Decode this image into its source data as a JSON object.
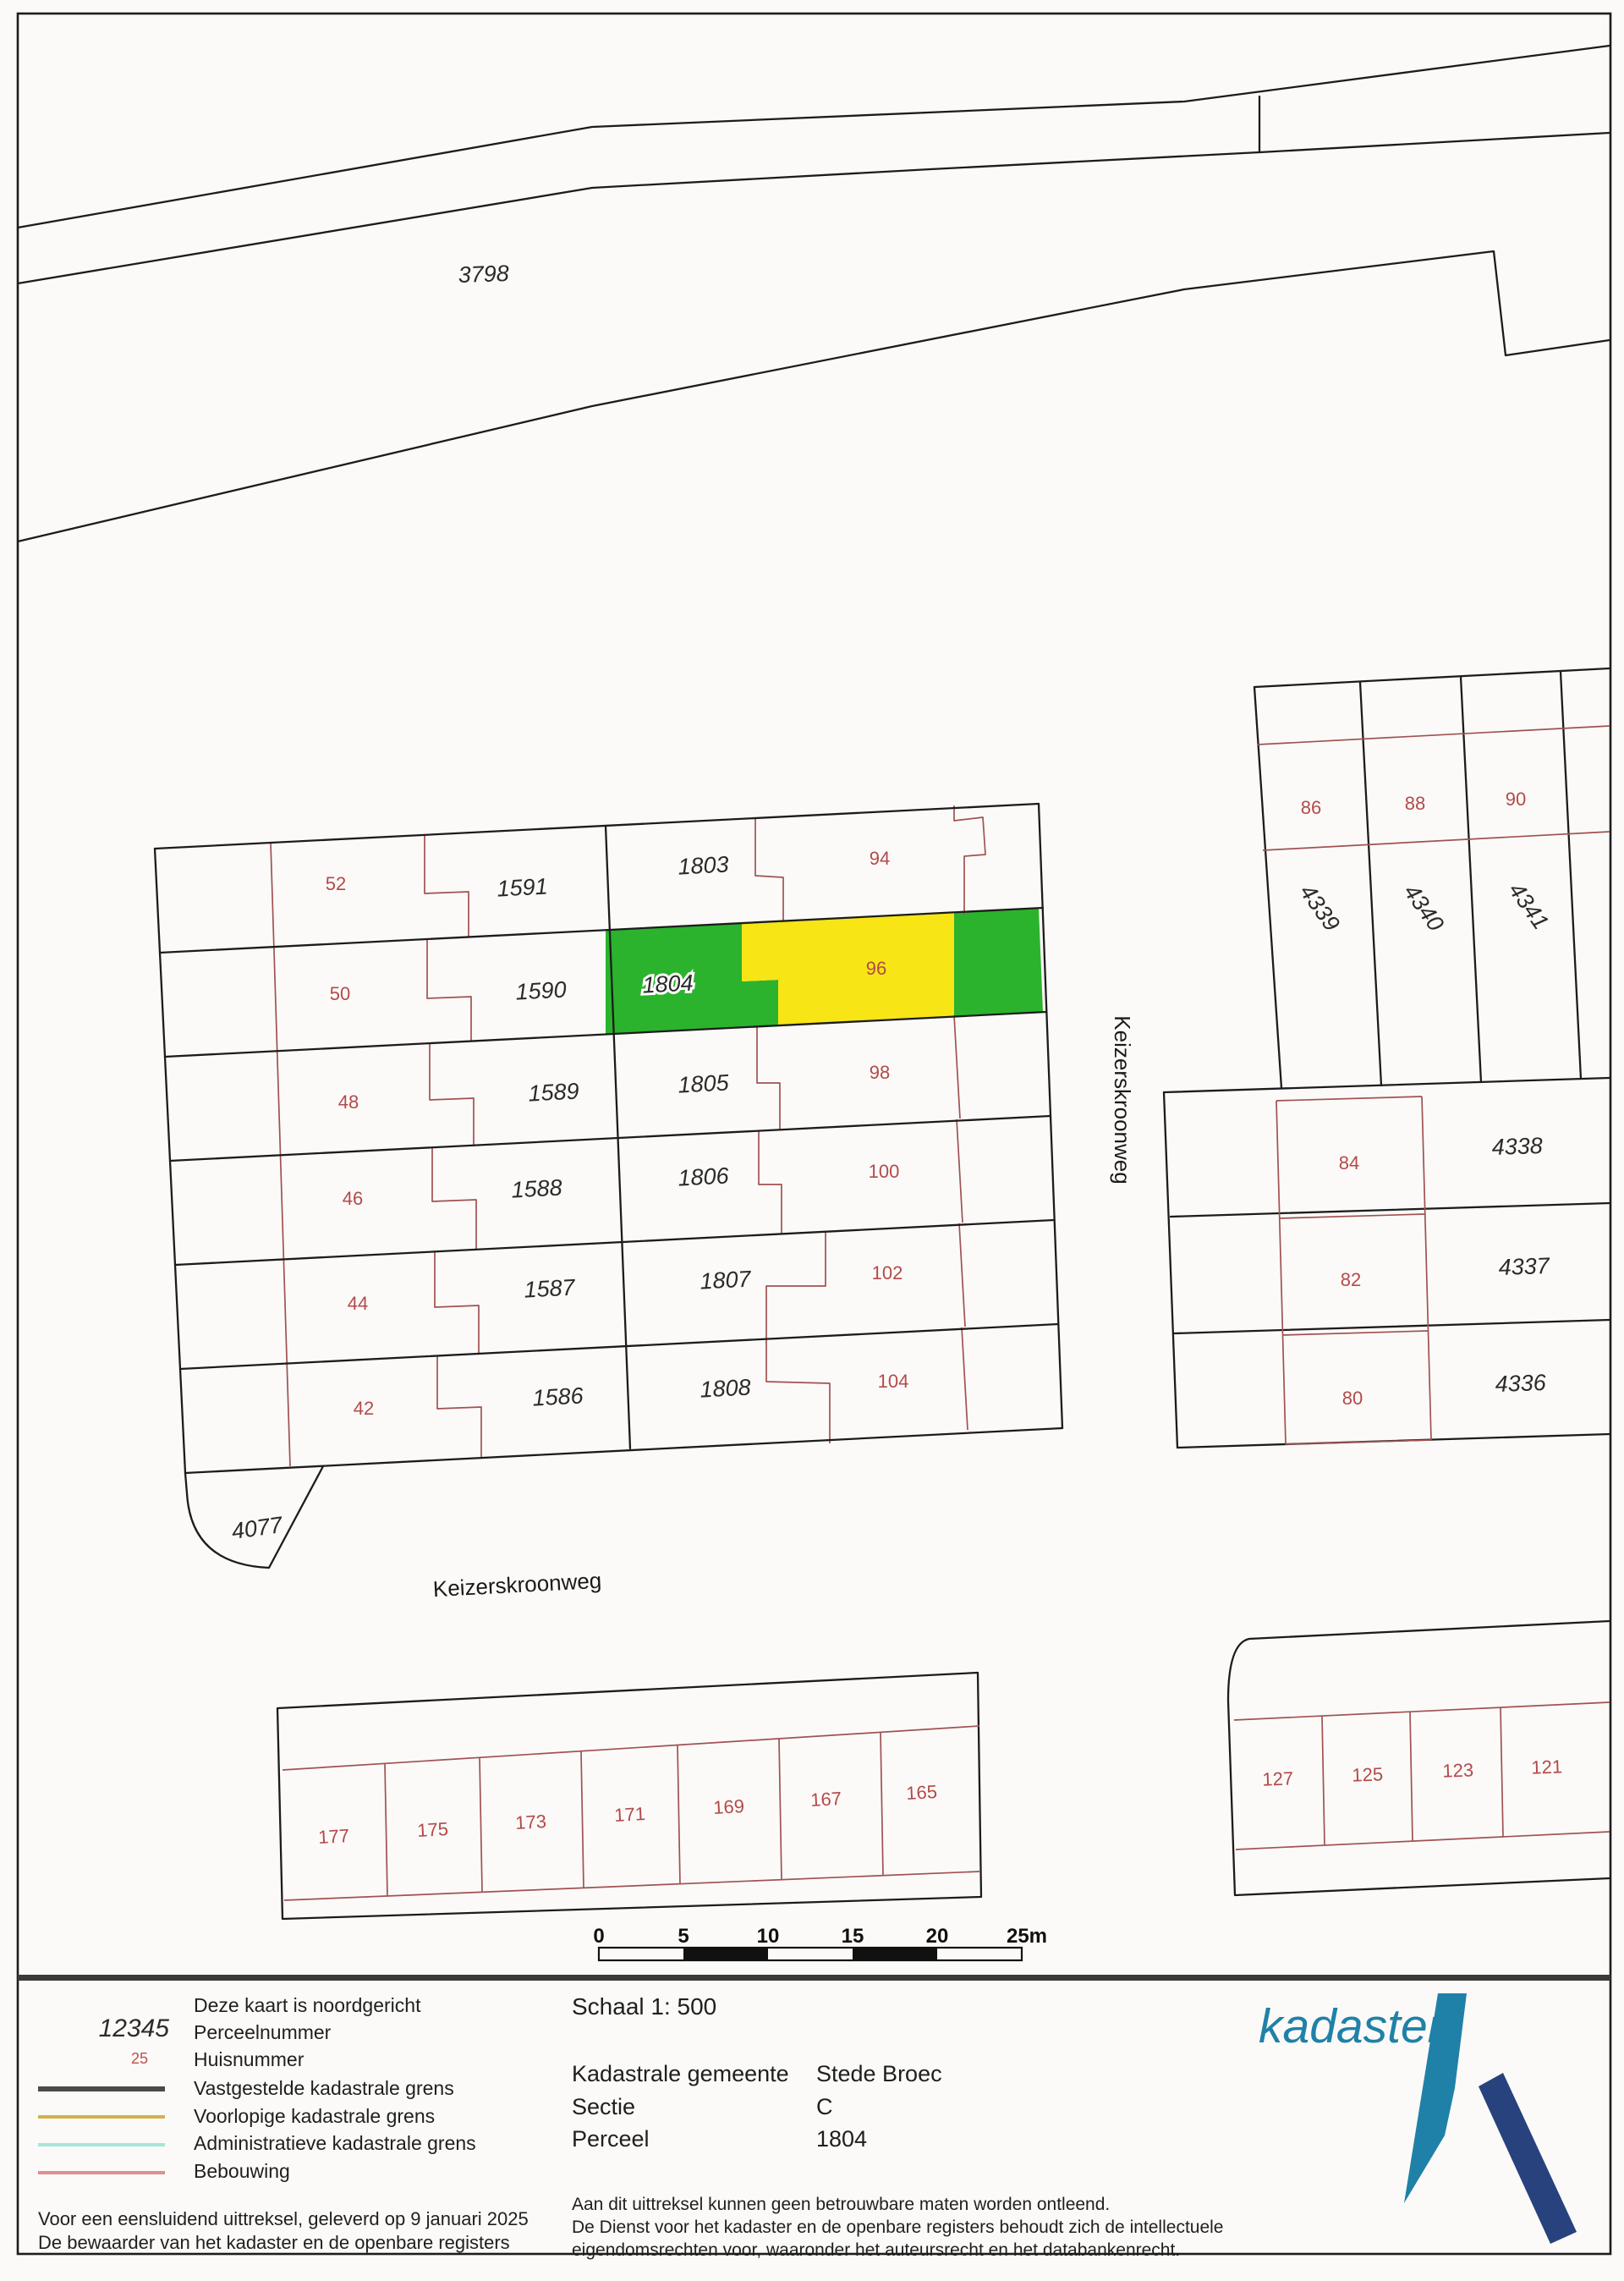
{
  "document": {
    "type": "Kadastrale kaart uittreksel",
    "colors": {
      "page_background": "#fbfaf8",
      "boundary_black": "#1c1c1c",
      "building_red": "#a05252",
      "house_number_red": "#b34a4a",
      "parcel_number_black": "#2b2b2b",
      "highlight_green": "#2bb32d",
      "highlight_yellow": "#f7e515",
      "legend_vastgesteld": "#4a4a4a",
      "legend_voorlopig": "#d2b24a",
      "legend_administratief": "#a5e6d9",
      "legend_bebouwing": "#de8f8f",
      "logo_teal": "#1f81a8",
      "logo_dark_blue": "#28427e",
      "panel_separator": "#3a3a3a"
    }
  },
  "map": {
    "labels": {
      "p3798": "3798",
      "p1591": "1591",
      "p1590": "1590",
      "p1589": "1589",
      "p1588": "1588",
      "p1587": "1587",
      "p1586": "1586",
      "p4077": "4077",
      "p1803": "1803",
      "p1804": "1804",
      "p1805": "1805",
      "p1806": "1806",
      "p1807": "1807",
      "p1808": "1808",
      "p4339": "4339",
      "p4340": "4340",
      "p4341": "4341",
      "p4338": "4338",
      "p4337": "4337",
      "p4336": "4336",
      "h52": "52",
      "h50": "50",
      "h48": "48",
      "h46": "46",
      "h44": "44",
      "h42": "42",
      "h94": "94",
      "h96": "96",
      "h98": "98",
      "h100": "100",
      "h102": "102",
      "h104": "104",
      "h86": "86",
      "h88": "88",
      "h90": "90",
      "h84": "84",
      "h82": "82",
      "h80": "80",
      "h177": "177",
      "h175": "175",
      "h173": "173",
      "h171": "171",
      "h169": "169",
      "h167": "167",
      "h165": "165",
      "h127": "127",
      "h125": "125",
      "h123": "123",
      "h121": "121",
      "street_vertical": "Keizerskroonweg",
      "street_horizontal": "Keizerskroonweg"
    },
    "highlighted_parcel": "1804"
  },
  "scalebar": {
    "ticks": [
      "0",
      "5",
      "10",
      "15",
      "20",
      "25m"
    ]
  },
  "legend": {
    "north_note": "Deze kaart is noordgericht",
    "perceel_sample": "12345",
    "perceel_label": "Perceelnummer",
    "huis_sample": "25",
    "huis_label": "Huisnummer",
    "vastgesteld_label": "Vastgestelde kadastrale grens",
    "voorlopig_label": "Voorlopige kadastrale grens",
    "administratief_label": "Administratieve kadastrale grens",
    "bebouwing_label": "Bebouwing",
    "footer_line1": "Voor een eensluidend uittreksel, geleverd op 9 januari 2025",
    "footer_line2": "De bewaarder van het kadaster en de openbare registers"
  },
  "info": {
    "schaal": "Schaal 1: 500",
    "rows": [
      {
        "label": "Kadastrale gemeente",
        "value": "Stede Broec"
      },
      {
        "label": "Sectie",
        "value": "C"
      },
      {
        "label": "Perceel",
        "value": "1804"
      }
    ],
    "disclaimer1": "Aan dit uittreksel kunnen geen betrouwbare maten worden ontleend.",
    "disclaimer2": "De Dienst voor het kadaster en de openbare registers behoudt zich de intellectuele",
    "disclaimer3": "eigendomsrechten voor, waaronder het auteursrecht en het databankenrecht."
  },
  "logo": {
    "wordmark": "kadaster"
  }
}
